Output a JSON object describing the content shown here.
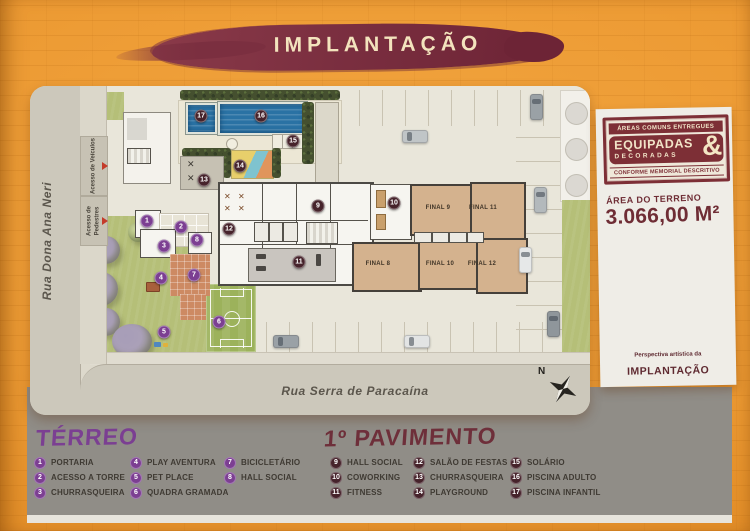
{
  "colors": {
    "orange": "#EC9A33",
    "maroon_brush": "#7B2F40",
    "stamp_red": "#7D2F36",
    "purple": "#7C3F92",
    "marker_dark": "#46232B",
    "legend_gray": "#908D87",
    "plan_cream": "#DDD9CC"
  },
  "banner": {
    "title": "IMPLANTAÇÃO"
  },
  "right_panel": {
    "stamp": {
      "top": "ÁREAS COMUNS ENTREGUES",
      "main": "EQUIPADAS",
      "sub": "DECORADAS",
      "amp": "&",
      "bottom": "CONFORME MEMORIAL DESCRITIVO"
    },
    "terrain_label": "ÁREA DO TERRENO",
    "terrain_value": "3.066,00 M²",
    "perspective_prefix": "Perspectiva artística da",
    "perspective_title": "IMPLANTAÇÃO"
  },
  "plan": {
    "street_left": "Rua Dona Ana Neri",
    "street_bottom": "Rua Serra de Paracaína",
    "compass_label": "N",
    "access": [
      {
        "line1": "Acesso de",
        "line2": "Veículos",
        "y": 50,
        "h": 58
      },
      {
        "line1": "Acesso de",
        "line2": "Pedestres",
        "y": 110,
        "h": 48
      }
    ],
    "units": [
      {
        "label": "FINAL 9",
        "x": 408,
        "y": 122
      },
      {
        "label": "FINAL 11",
        "x": 453,
        "y": 122
      },
      {
        "label": "FINAL 8",
        "x": 348,
        "y": 178
      },
      {
        "label": "FINAL 10",
        "x": 410,
        "y": 178
      },
      {
        "label": "FINAL 12",
        "x": 452,
        "y": 178
      }
    ],
    "markers": {
      "terreo": [
        {
          "n": "1",
          "x": 117,
          "y": 135
        },
        {
          "n": "2",
          "x": 151,
          "y": 141
        },
        {
          "n": "3",
          "x": 134,
          "y": 160
        },
        {
          "n": "4",
          "x": 131,
          "y": 192
        },
        {
          "n": "5",
          "x": 134,
          "y": 246
        },
        {
          "n": "6",
          "x": 189,
          "y": 236
        },
        {
          "n": "7",
          "x": 164,
          "y": 189
        },
        {
          "n": "8",
          "x": 167,
          "y": 154
        }
      ],
      "pavimento": [
        {
          "n": "9",
          "x": 288,
          "y": 120
        },
        {
          "n": "10",
          "x": 364,
          "y": 117
        },
        {
          "n": "11",
          "x": 269,
          "y": 176
        },
        {
          "n": "12",
          "x": 199,
          "y": 143
        },
        {
          "n": "13",
          "x": 174,
          "y": 94
        },
        {
          "n": "14",
          "x": 210,
          "y": 80
        },
        {
          "n": "15",
          "x": 263,
          "y": 55
        },
        {
          "n": "16",
          "x": 231,
          "y": 30
        },
        {
          "n": "17",
          "x": 171,
          "y": 30
        }
      ]
    }
  },
  "legend": {
    "terreo": {
      "title": "TÉRREO",
      "columns": [
        [
          {
            "n": "1",
            "label": "PORTARIA"
          },
          {
            "n": "2",
            "label": "ACESSO A TORRE"
          },
          {
            "n": "3",
            "label": "CHURRASQUEIRA"
          }
        ],
        [
          {
            "n": "4",
            "label": "PLAY AVENTURA"
          },
          {
            "n": "5",
            "label": "PET PLACE"
          },
          {
            "n": "6",
            "label": "QUADRA GRAMADA"
          }
        ],
        [
          {
            "n": "7",
            "label": "BICICLETÁRIO"
          },
          {
            "n": "8",
            "label": "HALL SOCIAL"
          }
        ]
      ]
    },
    "pavimento": {
      "title": "1º PAVIMENTO",
      "columns": [
        [
          {
            "n": "9",
            "label": "HALL SOCIAL"
          },
          {
            "n": "10",
            "label": "COWORKING"
          },
          {
            "n": "11",
            "label": "FITNESS"
          }
        ],
        [
          {
            "n": "12",
            "label": "SALÃO DE FESTAS"
          },
          {
            "n": "13",
            "label": "CHURRASQUEIRA"
          },
          {
            "n": "14",
            "label": "PLAYGROUND"
          }
        ],
        [
          {
            "n": "15",
            "label": "SOLÁRIO"
          },
          {
            "n": "16",
            "label": "PISCINA ADULTO"
          },
          {
            "n": "17",
            "label": "PISCINA INFANTIL"
          }
        ]
      ]
    }
  }
}
